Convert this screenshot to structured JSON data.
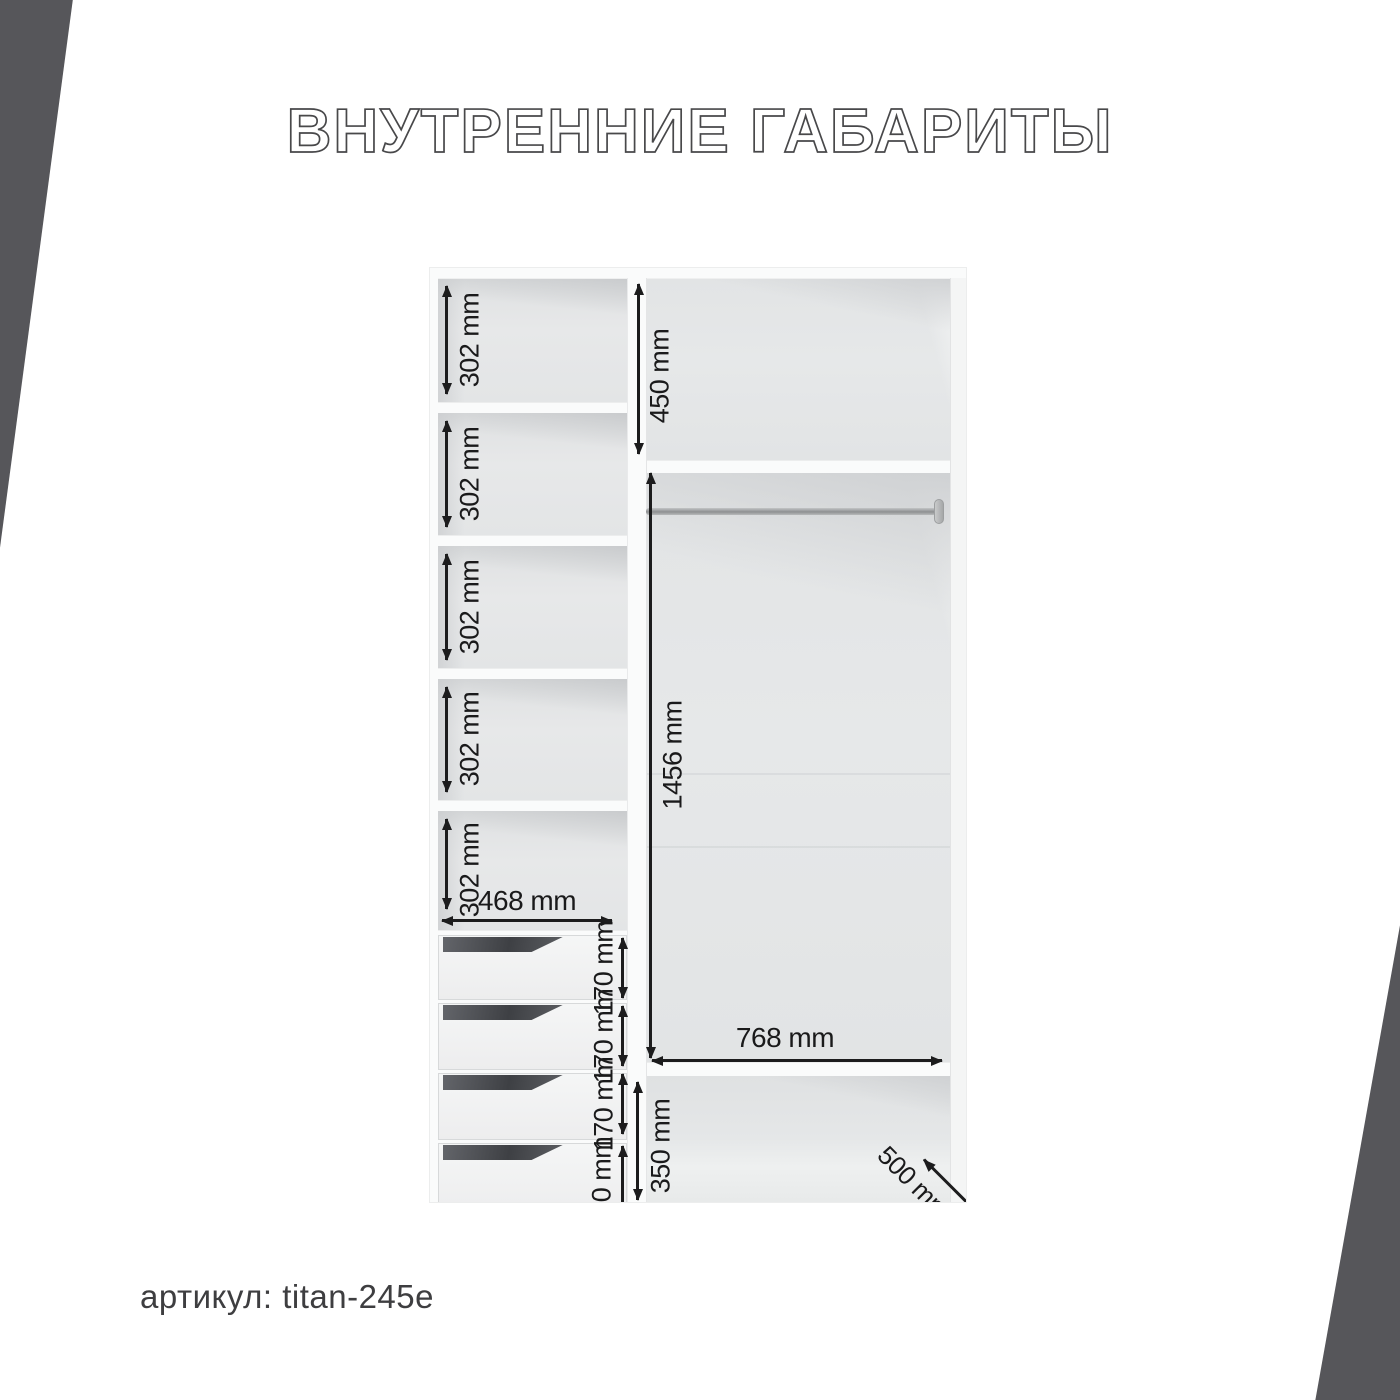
{
  "title": "ВНУТРЕННИЕ ГАБАРИТЫ",
  "footer": {
    "article_label": "артикул: titan-245e"
  },
  "colors": {
    "accent_corner": "#56565a",
    "dimension_text": "#1c1c1d",
    "cabinet_interior": "#e5e7e8"
  },
  "diagram": {
    "left_column": {
      "shelf_dims": [
        "302 mm",
        "302 mm",
        "302 mm",
        "302 mm",
        "302 mm"
      ],
      "width_dim": "468 mm",
      "drawer_dims": [
        "170 mm",
        "170 mm",
        "170 mm",
        "170 mm"
      ]
    },
    "right_column": {
      "top_shelf_dim": "450 mm",
      "hanging_dim": "1456 mm",
      "width_dim": "768 mm",
      "bottom_shelf_dim": "350 mm",
      "depth_dim": "500 mm"
    }
  }
}
